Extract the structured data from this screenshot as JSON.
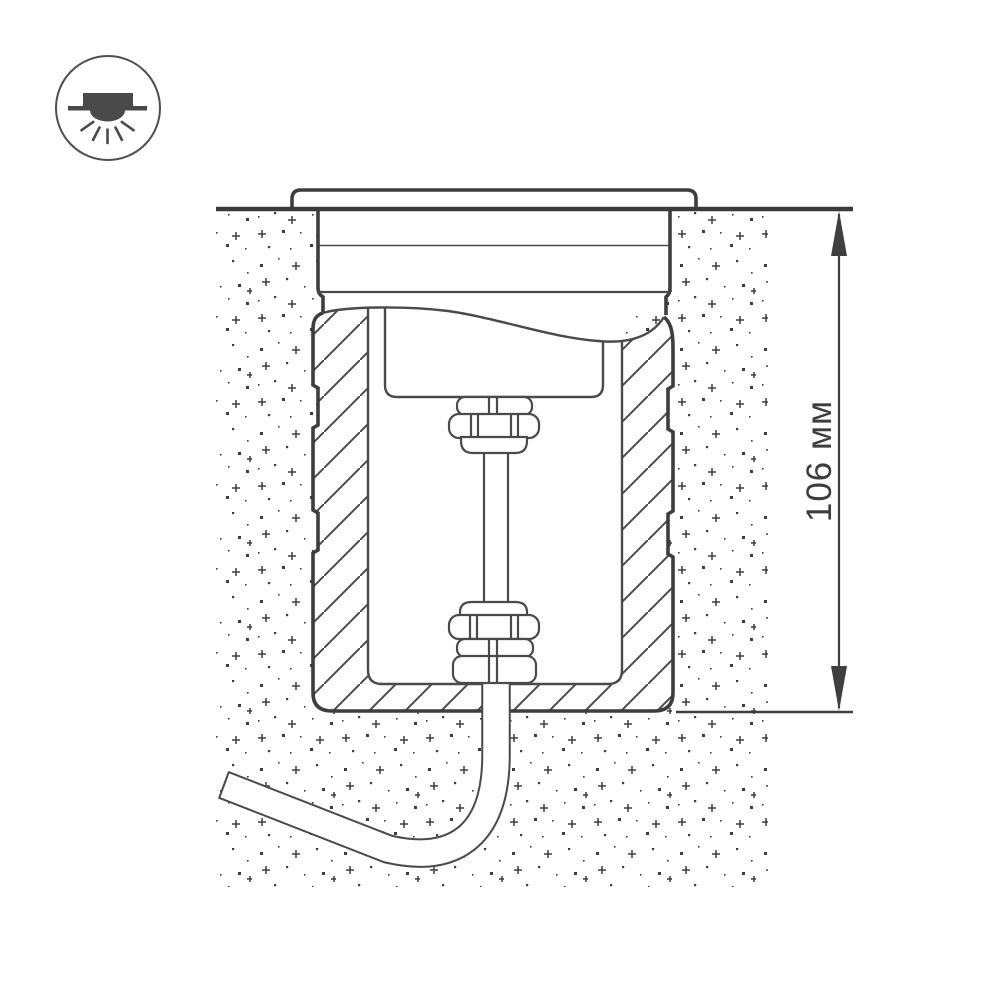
{
  "page": {
    "background": "#ffffff",
    "ink_color": "#3f3f3f"
  },
  "icon_badge": {
    "name": "recessed-downlight-icon"
  },
  "dimension": {
    "label": "106 мм",
    "value": "106",
    "unit": "мм"
  }
}
